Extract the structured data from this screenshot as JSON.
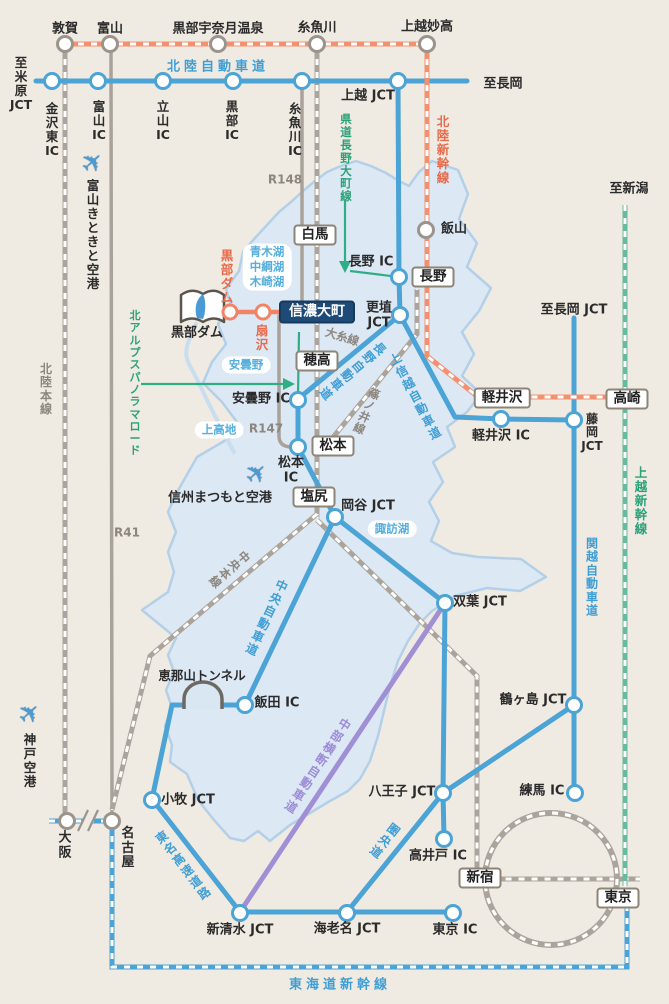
{
  "colors": {
    "background": "#f0ebe2",
    "prefecture_fill": "#dce8f4",
    "prefecture_border": "#b3d0e8",
    "expressway_blue": "#4ba3d6",
    "railway_gray": "#aba49c",
    "road_gray": "#a9a29a",
    "shinkansen_orange": "#f29070",
    "shinkansen_green": "#66bb9e",
    "chubu_odan_purple": "#a18fd6",
    "route_green": "#2fae85",
    "dam_route_orange": "#f08465",
    "destination_box": "#1e4a78",
    "lake_text_blue": "#54aede"
  },
  "directions": {
    "maibara": "至\n米\n原\nJCT",
    "nagaoka": "至長岡",
    "nagaoka_jct": "至長岡 JCT",
    "niigata": "至新潟"
  },
  "stations": {
    "tsuruga": "敦賀",
    "toyama": "富山",
    "kurobe_unazuki_onsen": "黒部宇奈月温泉",
    "itoigawa": "糸魚川",
    "joetsu_myoko": "上越妙高",
    "iiyama": "飯山",
    "osaka": "大\n阪",
    "nagoya": "名\n古\n屋"
  },
  "boxes": {
    "hakuba": "白馬",
    "nagano": "長野",
    "hotaka": "穂高",
    "matsumoto": "松本",
    "shiojiri": "塩尻",
    "karuizawa": "軽井沢",
    "takasaki": "高崎",
    "shinjuku": "新宿",
    "tokyo": "東京",
    "shinano_omachi": "信濃大町"
  },
  "interchanges": {
    "kanazawa_higashi_ic": "金\n沢\n東\nIC",
    "toyama_ic": "富\n山\nIC",
    "tateyama_ic": "立\n山\nIC",
    "kurobe_ic": "黒\n部\nIC",
    "itoigawa_ic": "糸\n魚\n川\nIC",
    "joetsu_jct": "上越 JCT",
    "nagano_ic": "長野 IC",
    "koshoku_jct": "更埴\nJCT",
    "azumino_ic": "安曇野 IC",
    "matsumoto_ic": "松本\nIC",
    "karuizawa_ic": "軽井沢 IC",
    "fujioka_jct": "藤\n岡\nJCT",
    "okaya_jct": "岡谷 JCT",
    "futaba_jct": "双葉 JCT",
    "tsurugashima_jct": "鶴ヶ島 JCT",
    "iida_ic": "飯田 IC",
    "komaki_jct": "小牧 JCT",
    "hachioji_jct": "八王子 JCT",
    "nerima_ic": "練馬 IC",
    "takaido_ic": "高井戸 IC",
    "shin_shimizu_jct": "新清水 JCT",
    "ebina_jct": "海老名 JCT",
    "tokyo_ic": "東京 IC"
  },
  "expressways": {
    "hokuriku": "北陸自動車道",
    "joshinetsu": "上信越自動車道",
    "nagano": "長野自動車道",
    "chuo": "中央自動車道",
    "kenodo": "圏央道",
    "kanetsu": "関\n越\n自\n動\n車\n道",
    "tomei": "東名高速道路",
    "chubu_odan": "中部横断自動車道"
  },
  "railways": {
    "hokuriku_honsen": "北\n陸\n本\n線",
    "oito_line": "大糸線",
    "shinonoi_line": "篠ノ井線",
    "chuo_honsen": "中央本線",
    "hokuriku_shinkansen": "北\n陸\n新\n幹\n線",
    "joetsu_shinkansen": "上\n越\n新\n幹\n線",
    "tokaido_shinkansen": "東海道新幹線"
  },
  "roads": {
    "r41": "R41",
    "r147": "R147",
    "r148": "R148",
    "kendo_nagano_omachi": "県\n道\n長\n野\n大\n町\n線",
    "panorama_road": "北\nア\nル\nプ\nス\nパ\nノ\nラ\nマ\nロ\nー\nド"
  },
  "landmarks": {
    "kurobe_dam": "黒部ダム",
    "kurobe_dam_station": "黒\n部\nダ\nム",
    "ogizawa": "扇\n沢",
    "enasan_tunnel": "恵那山トンネル"
  },
  "lakes": {
    "aoki_nakatsuna_kizaki": "青木湖\n中綱湖\n木崎湖",
    "azumino": "安曇野",
    "kamikochi": "上高地",
    "suwako": "諏訪湖"
  },
  "airports": {
    "toyama_kitokito": "富\n山\nき\nと\nき\nと\n空\n港",
    "shinshu_matsumoto": "信州まつもと空港",
    "kobe": "神\n戸\n空\n港"
  }
}
